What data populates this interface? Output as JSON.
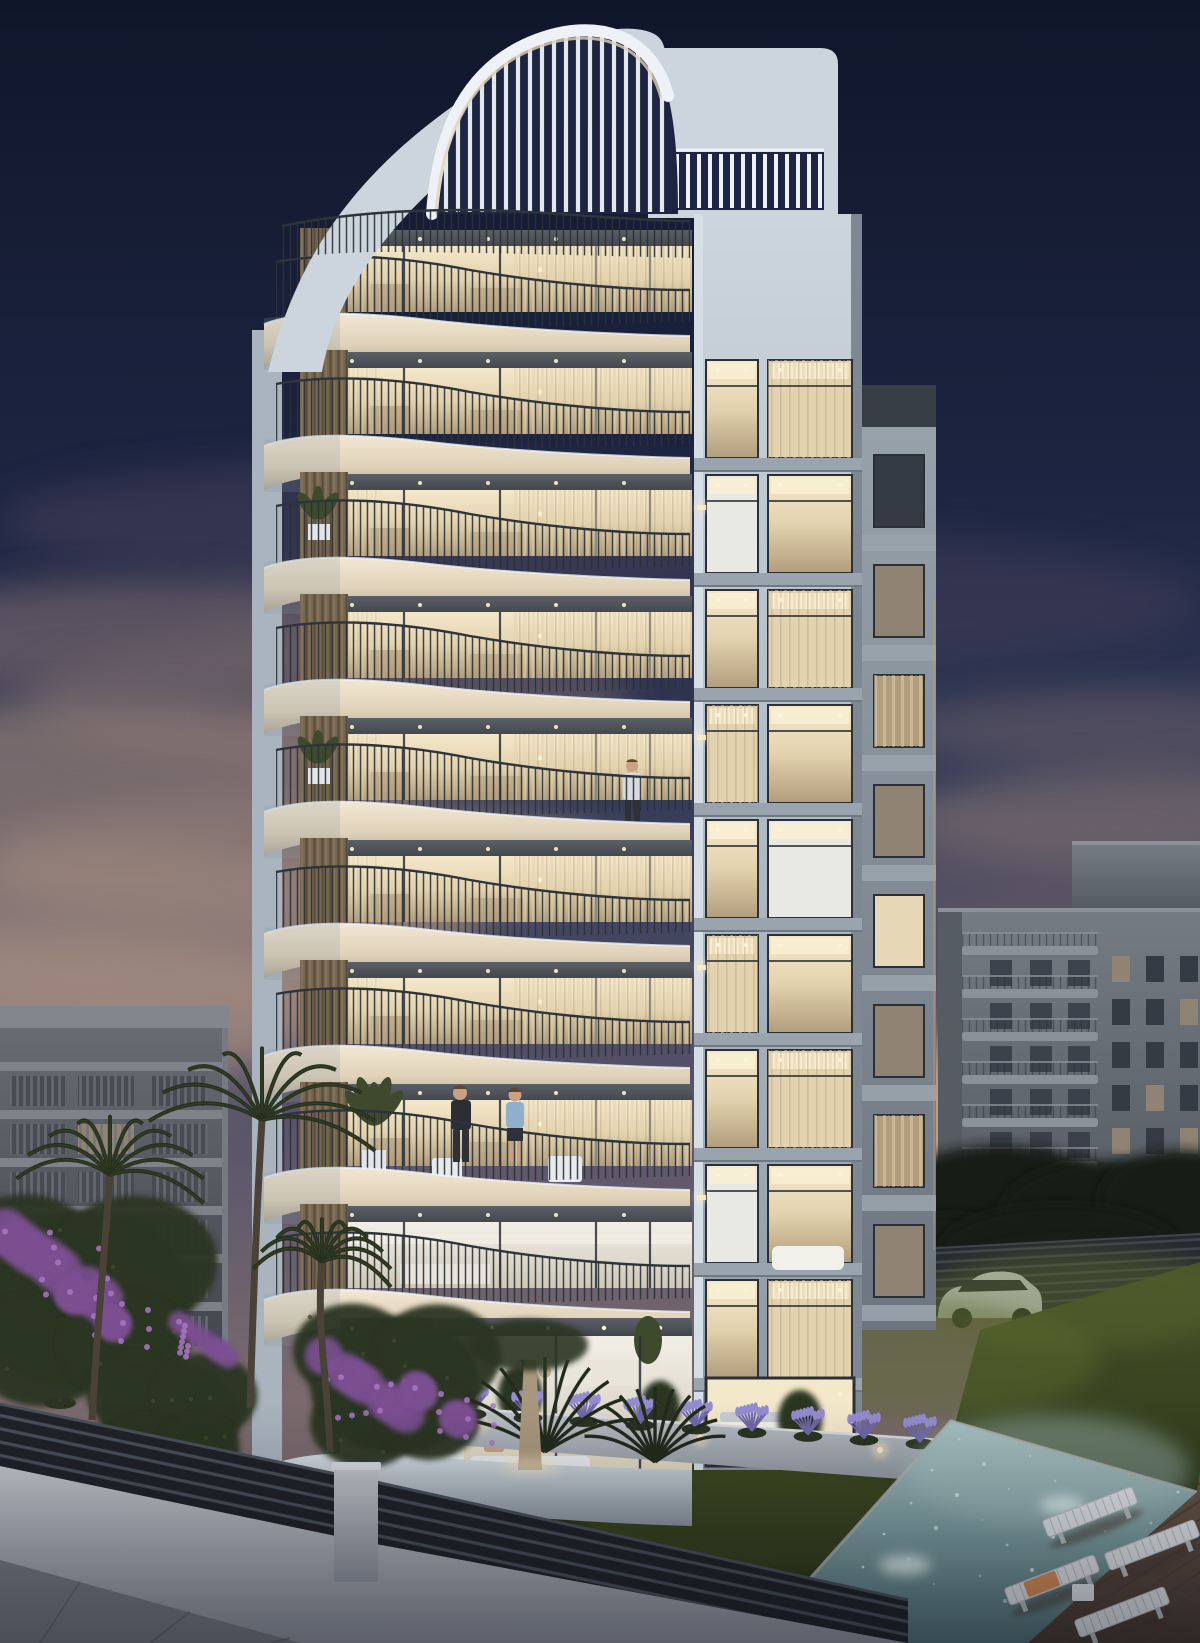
{
  "scene": {
    "description": "Photorealistic dusk rendering of a modern nine-storey apartment tower with sculptural wavy white balconies and a curved slatted roof pergola. Warmly lit interiors glow through floor-to-ceiling glazing. Foreground shows a landscaped garden with palms, lavender, purple bougainvillea, a dark horizontal-slat fence, a swimming pool with sun loungers on a wooden deck, parked cars, and neighbouring apartment blocks under a navy sky with mauve clouds and an orange sunset glow on the right horizon.",
    "time_of_day": "dusk",
    "weather": "clear with scattered mauve clouds and sunset glow"
  },
  "structure": {
    "wavy_floors": 9,
    "floor_first_top": 218,
    "floor_step": 122,
    "floor_styles": [
      "warm",
      "warm",
      "warm",
      "warm",
      "warm",
      "warm",
      "warm",
      "warm",
      "white"
    ],
    "balcony_plant_floors": [
      2,
      4
    ],
    "towerA_rows": 9,
    "towerA_first_y": 356,
    "towerA_step": 115,
    "towerA_styles": [
      [
        "lit",
        "curtain"
      ],
      [
        "white",
        "lit"
      ],
      [
        "lit",
        "curtain"
      ],
      [
        "curtain",
        "lit"
      ],
      [
        "lit",
        "white"
      ],
      [
        "curtain",
        "lit"
      ],
      [
        "lit",
        "curtain"
      ],
      [
        "white",
        "lit"
      ],
      [
        "lit",
        "curtain"
      ]
    ],
    "towerB_styles": [
      "dark",
      "dim",
      "curtain",
      "dim",
      "lit",
      "dim",
      "curtain",
      "dim"
    ],
    "rightB_floors": 7,
    "rightB_lit": [
      [
        0
      ],
      [
        2
      ],
      [],
      [
        1
      ],
      [
        0,
        2
      ],
      [],
      [
        1
      ]
    ],
    "leftB_floors": 6,
    "leftB_lit": [
      [],
      [
        1
      ],
      [],
      [
        0
      ],
      [],
      []
    ],
    "pergola_slats": 19,
    "loungers": 4,
    "palms": 3,
    "cars": [
      {
        "type": "suv",
        "color_key": "car_white"
      },
      {
        "type": "coupe",
        "color_key": "car_yellow"
      }
    ],
    "people": [
      {
        "id": "couple-on-terrace",
        "floor": 7
      },
      {
        "id": "man-on-balcony",
        "floor": 4
      },
      {
        "id": "woman-seated-ground",
        "location": "ground-terrace"
      }
    ]
  },
  "colors": {
    "sky_top": "#10162a",
    "sky_upper": "#1d2542",
    "sky_mid": "#3a405c",
    "sky_lower": "#5d566b",
    "sky_horizon": "#7a6a6e",
    "cloud_dark": "#46425c",
    "cloud_mauve": "#70626a",
    "cloud_warm": "#8d7a74",
    "cloud_light": "#a18a7e",
    "sunset_core": "#f6c98f",
    "sunset_mid": "#dd9c66",
    "sunset_deep": "#a06b4d",
    "left_glow": "#9c8680",
    "white_hi": "#eef2f6",
    "bldg_light": "#ccd5dd",
    "bldg_mid": "#aab4be",
    "bldg_shadow": "#8a949e",
    "corner_lit": "#d6dee5",
    "edge_dark": "#7e8893",
    "slab_hi": "#f2e7d3",
    "slab_mid": "#e0d2b9",
    "slab_low": "#c0b4a0",
    "slab_end": "#a8a79f",
    "soffit_hi": "#5b5f66",
    "soffit_lo": "#41454c",
    "glass_hi": "#f4e8cb",
    "glass_mid": "#e3d2ae",
    "glass_lo": "#b19d7c",
    "glass_white_hi": "#f2efe7",
    "glass_white_lo": "#cfc8b8",
    "frame_dark": "#2b3036",
    "rail_dark": "#2e343b",
    "bar_dark": "#2a3036",
    "wood_hi": "#8a7960",
    "wood_mid": "#77664f",
    "wood_lo": "#5a4c3a",
    "spandrel": "#9aa4ae",
    "spandrel_shadow": "#6f7984",
    "towerB_hi": "#99a3ac",
    "towerB_lo": "#6d7680",
    "towerB_band": "#383e45",
    "rim_warm": "#c39a74",
    "win_dark": "#343b44",
    "win_dim": "#8f8374",
    "win_lit": "#e6d8b6",
    "win_white": "#e9e9e3",
    "ceil_glow": "#f8eed3",
    "dot_glow": "#fff3d6",
    "rightB_hi": "#757b83",
    "rightB_lo": "#525860",
    "rightB_slab": "#8a9199",
    "rightB_shadow": "#565c64",
    "leftB_hi": "#666b72",
    "leftB_lo": "#43474e",
    "leftB_band": "#82878e",
    "leftB_win": "#474c53",
    "leftB_stripe": "#6d7279",
    "treeline": "#161c12",
    "house_dark": "#3a4046",
    "grass_hi": "#44512a",
    "grass_mid": "#333f1d",
    "grass_lo": "#1c220f",
    "grass_patch": "#5a672e",
    "grass_lit": "#6a7638",
    "wall_hi": "#c2c7cd",
    "wall_lo": "#9299a1",
    "wall_top": "#d6dade",
    "fence_dark": "#1f2328",
    "fence_slat": "#49505a",
    "fence2_dark": "#262a30",
    "fence2_slat": "#3f454d",
    "pavement": "#777c84",
    "pavement_line": "#5f646c",
    "pool_hi": "#a7c0c1",
    "pool_mid": "#7fa1a3",
    "pool_lo": "#547578",
    "pool_spark": "#eaf4f2",
    "pool_glow": "#dff2ef",
    "coping": "#aeb4b2",
    "deck_hi": "#6d594a",
    "deck_lo": "#4a3a31",
    "deck_line": "#4e3d34",
    "lounger": "#e3e6e9",
    "lounger_line": "#b9bec2",
    "towel": "#d98f55",
    "foliage_dark": "#222b1c",
    "foliage": "#2a3422",
    "foliage_hi": "#3e4a2c",
    "palm_dark": "#26301e",
    "trunk": "#4a4237",
    "trunk_lit": "#a9977d",
    "lavender_stem": "#6f68a8",
    "lavender_tip": "#958bd1",
    "bougainvillea": "#7b4f92",
    "bougainvillea_hi": "#a877c4",
    "car_white": "#d9dde1",
    "car_glass": "#272c31",
    "car_yellow": "#d4a33b",
    "car_yellow_dark": "#a8772b",
    "wheel": "#16191d",
    "skin": "#c9a184",
    "hair_dark": "#5d4530",
    "shirt_light": "#d7dbdf",
    "shirt_blue": "#8fb0cc",
    "suit": "#2b2e35",
    "pants": "#2e3237",
    "bed_white": "#f2f0ea",
    "sofa_white": "#e8ebee",
    "cushion": "#c9cdd2",
    "table_white": "#eae5da",
    "interior_floor": "#e7ddc6",
    "glow_warm": "#ffeabf",
    "vignette": "#070b16"
  }
}
